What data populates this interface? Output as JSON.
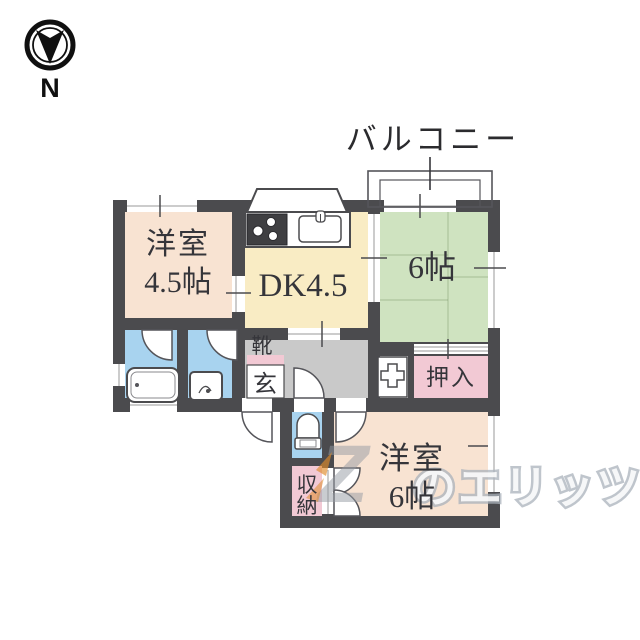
{
  "compass": {
    "label": "N",
    "icon": "compass-north-icon"
  },
  "balcony": {
    "label": "バルコニー"
  },
  "rooms": {
    "western_4_5": {
      "lines": [
        "洋室",
        "4.5帖"
      ]
    },
    "dining_kitchen": {
      "label": "DK4.5"
    },
    "tatami_6": {
      "label": "6帖"
    },
    "western_6": {
      "lines": [
        "洋室",
        "6帖"
      ]
    },
    "oshiire_closet": {
      "label": "押入"
    },
    "storage": {
      "label": "収納",
      "chars": [
        "収",
        "納"
      ]
    },
    "genkan": {
      "shoe_cabinet_label": "靴",
      "entrance_label": "玄"
    }
  },
  "fixtures": {
    "icons": [
      "bathtub-icon",
      "washbasin-icon",
      "toilet-icon",
      "gas-stove-icon",
      "kitchen-sink-icon",
      "washing-machine-pan-icon",
      "door-swing-arc",
      "window-glyph"
    ]
  },
  "watermark": {
    "logo_letter": "Z",
    "text": "のエリッツ"
  },
  "colors": {
    "wall": "#4b4b4e",
    "western_room_fill": "#f8e3d2",
    "dk_fill": "#f9ecc4",
    "tatami_fill": "#cfe3c0",
    "closet_pink_fill": "#f2c9d4",
    "water_blue_fill": "#a8d3ef",
    "genkan_gray_fill": "#c9c9c9",
    "watermark_gray": "#aab1bb",
    "watermark_orange": "#de8a2a"
  }
}
